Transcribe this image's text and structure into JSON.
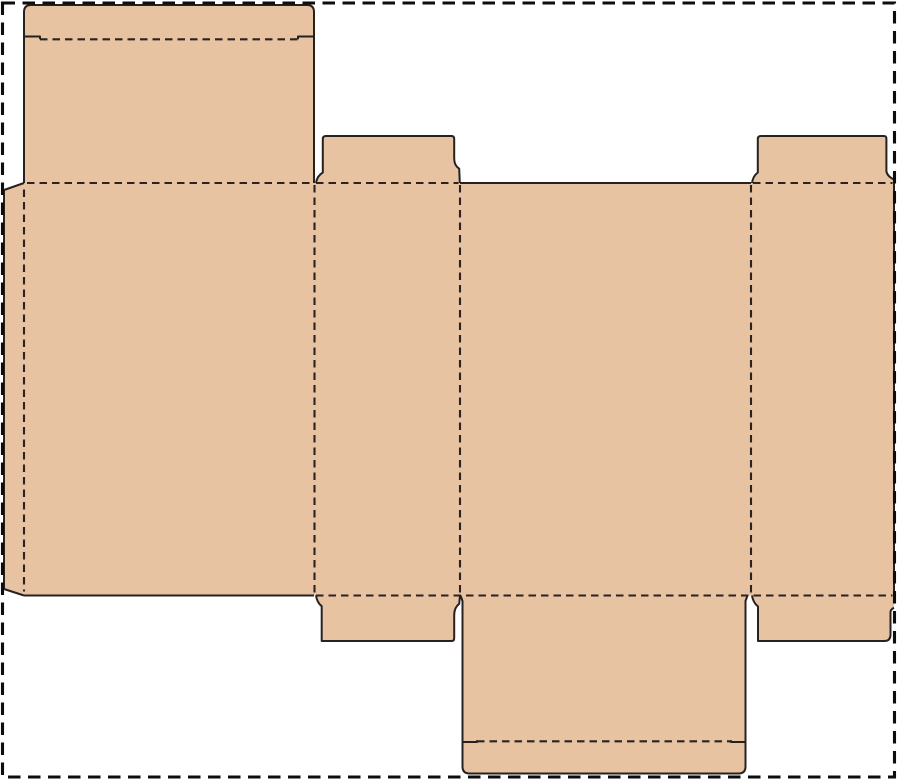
{
  "canvas": {
    "width": 900,
    "height": 780,
    "background": "#ffffff"
  },
  "diagram": {
    "type": "packaging-dieline",
    "title": "Folding-carton box die-cut template (flattened net)",
    "legend": {
      "solid_line_meaning": "cut",
      "dashed_line_meaning": "fold",
      "outer_dashed_rect_meaning": "sheet boundary"
    },
    "colors": {
      "board_fill": "#e7c3a1",
      "cut_line": "#272122",
      "fold_line": "#2b2322",
      "sheet_border": "#0d0d0d",
      "background": "#ffffff"
    },
    "line_styles": {
      "cut": {
        "width": 2,
        "dash": ""
      },
      "fold": {
        "width": 2.1,
        "dash": "7.5 5"
      },
      "border": {
        "width": 3.1,
        "dash": "12.5 7.5"
      }
    },
    "sheet_border": {
      "x": 2.5,
      "y": 3,
      "width": 892,
      "height": 774
    },
    "panels": [
      {
        "name": "lid-panel-with-tuck-flap",
        "path": "M24,183 L24,12 Q24,5 31,5 L307,5 Q314,5 314,12 L314,183 Z"
      },
      {
        "name": "left-side-panel-with-glue-tab",
        "path": "M4,190 L24,183 L314,183 L314,595.5 L24,595.5 L4,589 Z"
      },
      {
        "name": "main-panel-row",
        "path": "M314,183 L894,183 L894,595.5 L314,595.5 Z"
      },
      {
        "name": "top-dust-flap-left",
        "path": "M316,183 Q317,176 322.8,172.5 L322.8,139 Q322.8,136 326,136 L451.6,136 Q454.2,136 454.2,139 L454.2,158.5 Q454.2,165.5 459.2,168.7 L459.8,183 Z"
      },
      {
        "name": "top-dust-flap-right",
        "path": "M752,183 Q753,176 757.8,172.5 L757.8,139 Q757.8,136 761,136 L884,136 Q886.4,136 886.4,139 L886.4,171.5 Q887.5,176.5 894,179.5 L894,183 Z"
      },
      {
        "name": "bottom-dust-flap-left",
        "path": "M316,595.5 Q317,602.5 321.7,606.2 L321.7,641 L451.8,641 Q454.2,641 454.2,638 L454.2,615 Q454.2,607.5 459.2,603.8 L460,595.5 Z"
      },
      {
        "name": "bottom-dust-flap-right",
        "path": "M752,595.5 Q753,602.5 758,606.5 L758,641 L884.3,641 Q890.5,641 890.5,634.6 L890.5,611.5 Q891.3,609 894,607.8 L894,595.5 Z"
      },
      {
        "name": "bottom-lid-panel-with-tuck-flap",
        "path": "M460.5,595.5 L462.5,601 L462.5,766.5 Q462.5,773.5 469.5,773.5 L738.5,773.5 Q745.5,773.5 745.5,766.5 L745.5,601 L747.5,595.5 Z"
      }
    ],
    "fold_lines": [
      {
        "name": "lid-tuck-fold",
        "x1": 40,
        "y1": 39.3,
        "x2": 298,
        "y2": 39.3
      },
      {
        "name": "lid-to-left-panel-fold",
        "x1": 27,
        "y1": 183,
        "x2": 313,
        "y2": 183
      },
      {
        "name": "top-dust-flap-left-fold",
        "x1": 316,
        "y1": 183,
        "x2": 458.5,
        "y2": 183
      },
      {
        "name": "top-dust-flap-right-fold",
        "x1": 753,
        "y1": 183,
        "x2": 892.5,
        "y2": 183
      },
      {
        "name": "bottom-fold-row",
        "x1": 316,
        "y1": 595.5,
        "x2": 892.5,
        "y2": 595.5
      },
      {
        "name": "glue-tab-fold",
        "x1": 24,
        "y1": 189.5,
        "x2": 24,
        "y2": 591.5
      },
      {
        "name": "left-to-front-fold",
        "x1": 314.5,
        "y1": 185,
        "x2": 314.5,
        "y2": 594
      },
      {
        "name": "front-to-back-fold",
        "x1": 460,
        "y1": 185,
        "x2": 460,
        "y2": 594
      },
      {
        "name": "back-to-right-fold",
        "x1": 751,
        "y1": 185,
        "x2": 751,
        "y2": 594
      },
      {
        "name": "bottom-lid-tuck-fold",
        "x1": 477,
        "y1": 741.3,
        "x2": 731,
        "y2": 741.3
      }
    ],
    "cut_lines": [
      {
        "name": "lid-outline",
        "d": "M24,183 L24,12 Q24,5 31,5 L307,5 Q314,5 314,12 L314,183"
      },
      {
        "name": "lid-tuck-shoulder-left",
        "d": "M24,36.5 L40,36.5 L40,39.3"
      },
      {
        "name": "lid-tuck-shoulder-right",
        "d": "M314,36.5 L298,36.5 L298,39.3"
      },
      {
        "name": "glue-tab-outline",
        "d": "M24,183 L4,190 L4,589 L24,595.5"
      },
      {
        "name": "left-panel-bottom-edge",
        "d": "M24,595.5 L314,595.5"
      },
      {
        "name": "back-panel-top-edge",
        "d": "M460,183 L751,183"
      },
      {
        "name": "right-panel-outer-edge",
        "d": "M894,183 L894,595.5"
      },
      {
        "name": "top-dust-flap-left-outline",
        "d": "M316,183 Q317,176 322.8,172.5 L322.8,139 Q322.8,136 326,136 L451.6,136 Q454.2,136 454.2,139 L454.2,158.5 Q454.2,165.5 459.2,168.7 L459.8,183"
      },
      {
        "name": "top-dust-flap-right-outline",
        "d": "M752,183 Q753,176 757.8,172.5 L757.8,139 Q757.8,136 761,136 L884,136 Q886.4,136 886.4,139 L886.4,171.5 Q887.5,176.5 894,179.5"
      },
      {
        "name": "bottom-dust-flap-left-outline",
        "d": "M316,595.5 Q317,602.5 321.7,606.2 L321.7,641 L451.8,641 Q454.2,641 454.2,638 L454.2,615 Q454.2,607.5 459.2,603.8 L460,595.5"
      },
      {
        "name": "bottom-dust-flap-right-outline",
        "d": "M752,595.5 Q753,602.5 758,606.5 L758,641 L884.3,641 Q890.5,641 890.5,634.6 L890.5,611.5 Q891.3,609 894,607.8"
      },
      {
        "name": "bottom-lid-outline",
        "d": "M460.5,595.5 L462.5,601 L462.5,766.5 Q462.5,773.5 469.5,773.5 L738.5,773.5 Q745.5,773.5 745.5,766.5 L745.5,601 L747.5,595.5"
      },
      {
        "name": "bottom-tuck-shoulder-left",
        "d": "M462.5,742 L477,742 L477,740.3"
      },
      {
        "name": "bottom-tuck-shoulder-right",
        "d": "M745.5,742 L731,742 L731,740.3"
      }
    ]
  }
}
